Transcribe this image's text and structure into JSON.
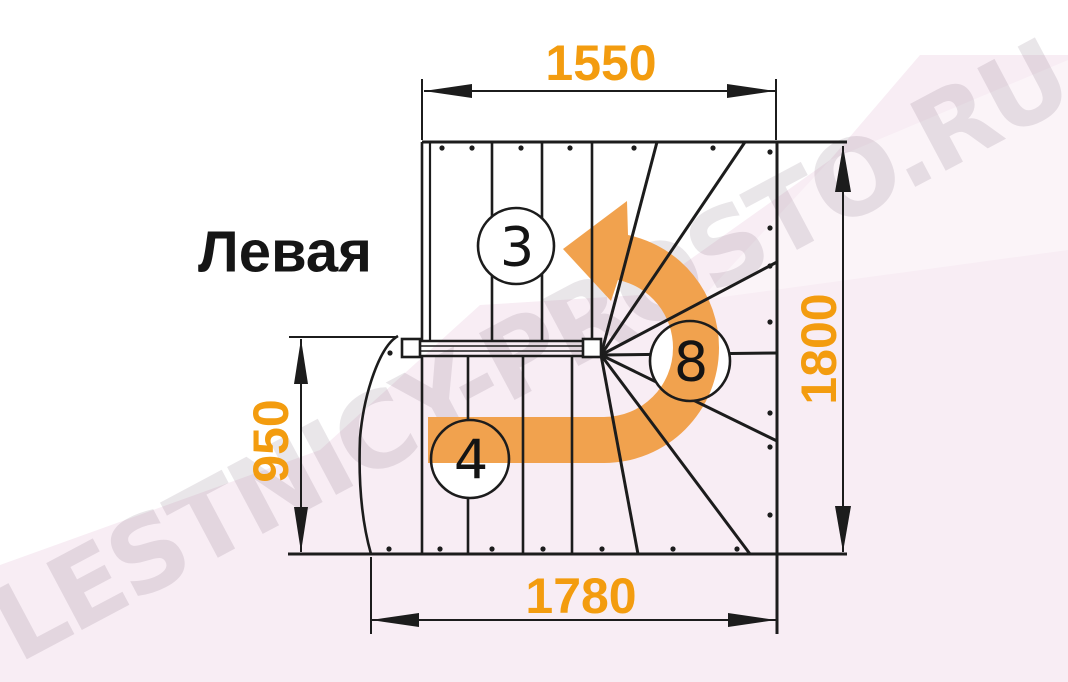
{
  "title_label": "Левая",
  "watermark_text": "LESTNICY-PROSTO.RU",
  "dimensions": {
    "top_width": "1550",
    "right_height": "1800",
    "left_height": "950",
    "bottom_width": "1780"
  },
  "step_counts": {
    "upper_flight": "3",
    "winder_turn": "8",
    "lower_flight": "4"
  },
  "colors": {
    "dimension_text": "#F39C0F",
    "arrow": "#F1A24E",
    "line": "#1C1C1C",
    "background_tint": "#F8EDF4"
  }
}
